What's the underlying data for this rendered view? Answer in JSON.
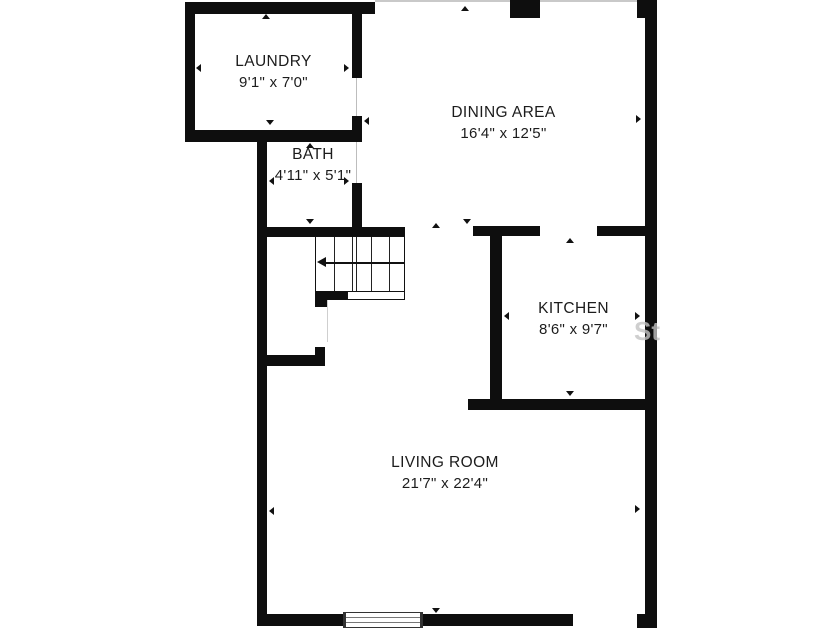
{
  "plan": {
    "rooms": [
      {
        "name": "LAUNDRY",
        "dimensions": "9'1\" x 7'0\""
      },
      {
        "name": "BATH",
        "dimensions": "4'11\" x 5'1\""
      },
      {
        "name": "DINING AREA",
        "dimensions": "16'4\" x 12'5\""
      },
      {
        "name": "KITCHEN",
        "dimensions": "8'6\" x 9'7\""
      },
      {
        "name": "LIVING ROOM",
        "dimensions": "21'7\" x 22'4\""
      }
    ],
    "features": {
      "stairs": "staircase with down-left direction arrow",
      "window": "window in living room bottom wall"
    },
    "watermark": "Ste",
    "colors": {
      "wall": "#0e0e0e",
      "background": "#ffffff",
      "text": "#1c1c1c",
      "watermark": "#c4c4c4"
    }
  }
}
